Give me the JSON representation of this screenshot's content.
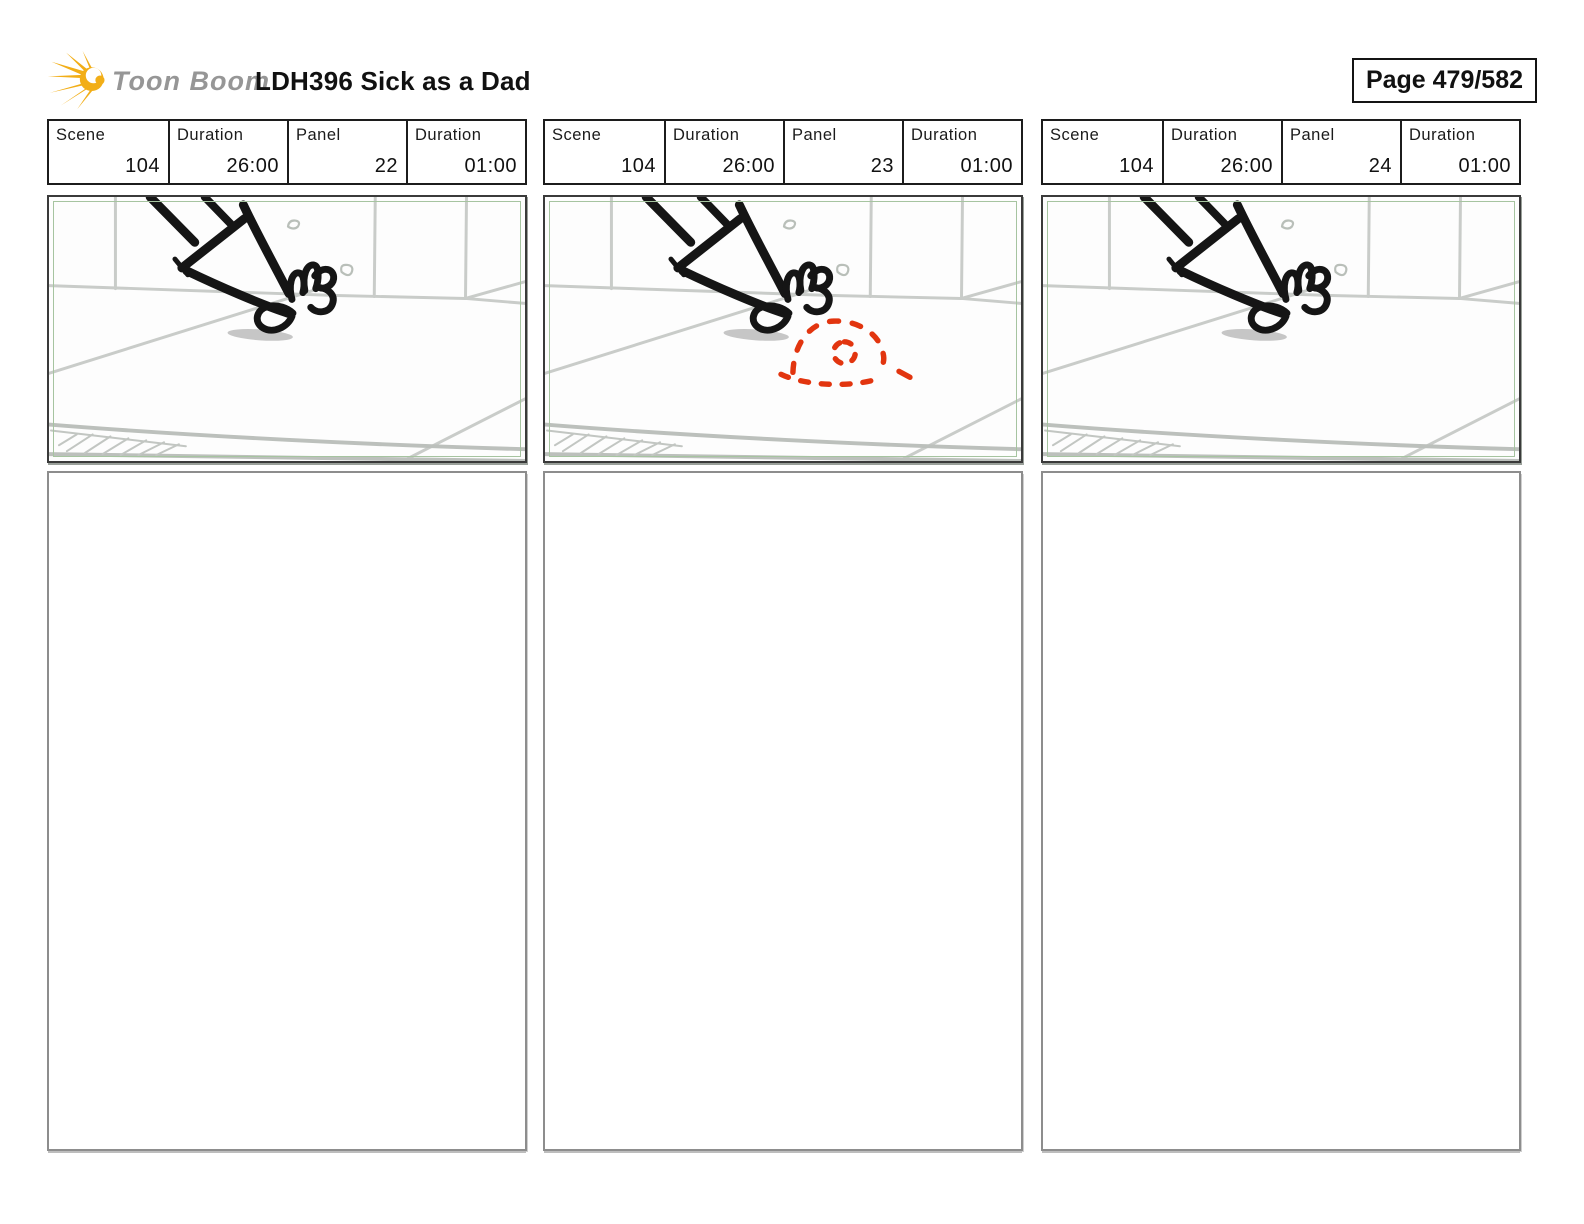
{
  "header": {
    "logo_text": "Toon Boom",
    "title": "LDH396 Sick as a Dad",
    "page_label": "Page 479/582"
  },
  "field_labels": {
    "scene": "Scene",
    "scene_duration": "Duration",
    "panel": "Panel",
    "panel_duration": "Duration"
  },
  "panels": [
    {
      "scene": "104",
      "scene_duration": "26:00",
      "panel_number": "22",
      "panel_duration": "01:00",
      "sketch": "hand-reaching-down-to-floor",
      "has_red_scribble": false,
      "notes": ""
    },
    {
      "scene": "104",
      "scene_duration": "26:00",
      "panel_number": "23",
      "panel_duration": "01:00",
      "sketch": "hand-reaching-down-to-floor-with-red-dashed-pile",
      "has_red_scribble": true,
      "notes": ""
    },
    {
      "scene": "104",
      "scene_duration": "26:00",
      "panel_number": "24",
      "panel_duration": "01:00",
      "sketch": "hand-reaching-down-to-floor",
      "has_red_scribble": false,
      "notes": ""
    }
  ],
  "colors": {
    "scribble_red": "#e2350f",
    "camera_frame_green": "#a6c4a0",
    "logo_gold": "#f2ae17",
    "logo_text_gray": "#969696"
  }
}
